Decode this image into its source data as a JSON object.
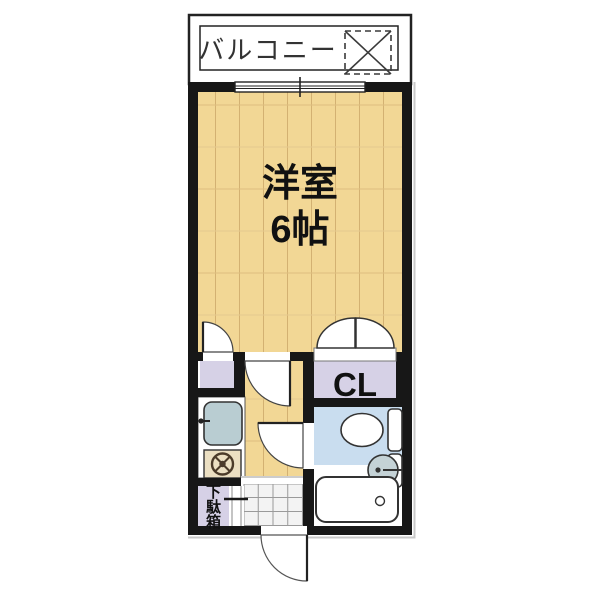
{
  "plan": {
    "type": "apartment-floorplan-1K",
    "balcony_label": "バルコニー",
    "main_room_label": "洋室",
    "main_room_size": "6帖",
    "closet_label": "CL",
    "shoe_cabinet_label": "下駄箱",
    "shoe_cabinet_char_1": "下",
    "shoe_cabinet_char_2": "駄",
    "shoe_cabinet_char_3": "箱"
  },
  "fixtures": [
    "washing-machine-space",
    "sliding-window",
    "closet-double-doors",
    "toilet",
    "wash-basin",
    "bathtub",
    "kitchen-sink",
    "stove-burner",
    "shoe-cabinet",
    "entrance-tile-floor",
    "entrance-door"
  ],
  "colors": {
    "wall": "#171717",
    "wood_floor": "#F2D795",
    "wood_grain": "#D3B172",
    "storage_purple": "#D6D1E6",
    "bathroom_blue": "#C9DDEF",
    "sink_blue_gray": "#B9CDD2",
    "stove_beige": "#EBDFC2",
    "burner_brown": "#4B3B2A",
    "tile_floor": "#F3F3F3",
    "background": "#FFFFFF"
  }
}
